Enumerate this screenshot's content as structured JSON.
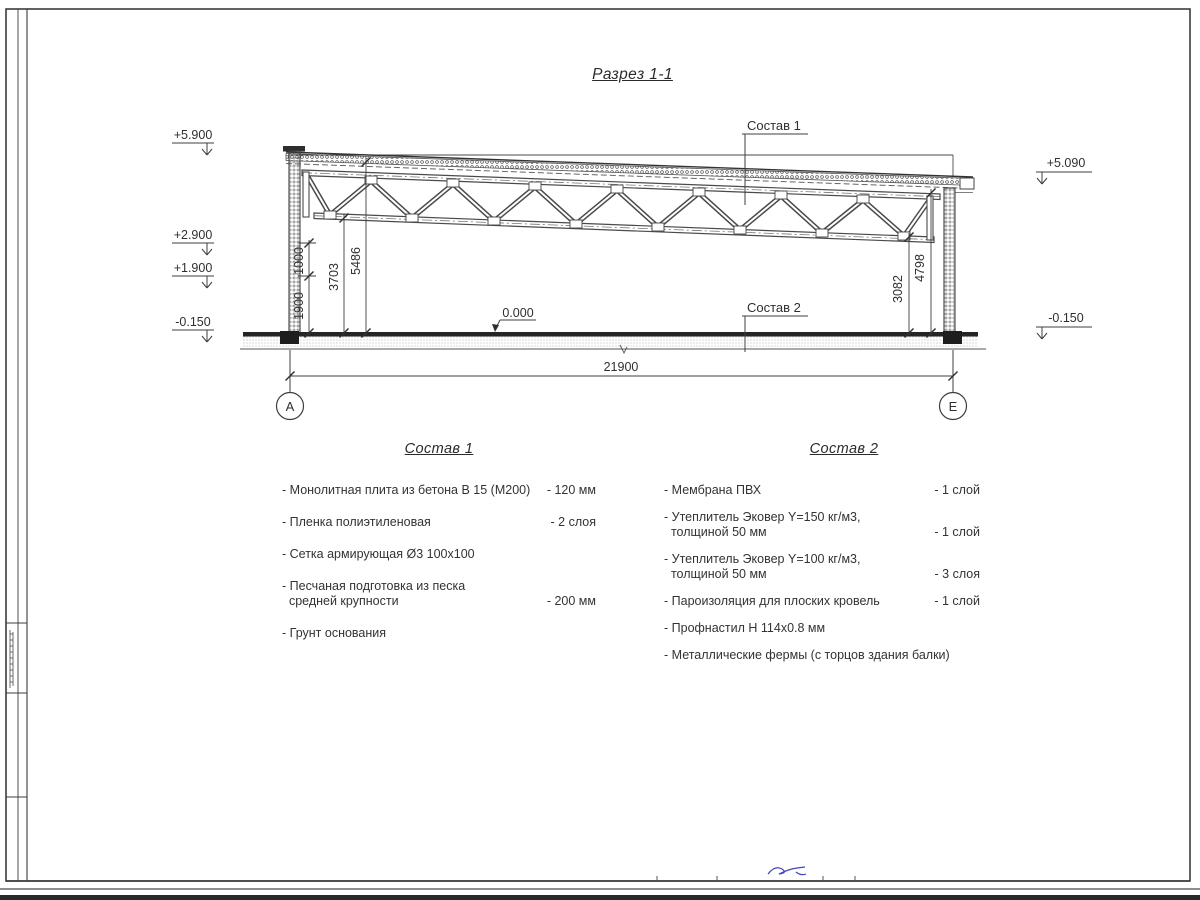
{
  "title": "Разрез 1-1",
  "drawing": {
    "left_elevations": [
      "+5.900",
      "+2.900",
      "+1.900",
      "-0.150"
    ],
    "right_elevations": [
      "+5.090",
      "-0.150"
    ],
    "floor_level": "0.000",
    "left_dims": [
      "1000",
      "1900",
      "3703",
      "5486"
    ],
    "right_dims": [
      "3082",
      "4798"
    ],
    "overall_dim": "21900",
    "composition1_label": "Состав 1",
    "composition2_label": "Состав 2",
    "grid_axes": [
      "А",
      "Е"
    ]
  },
  "composition1": {
    "heading": "Состав 1",
    "items": [
      {
        "name": "- Монолитная плита из бетона В 15 (М200)",
        "qty": "- 120 мм"
      },
      {
        "name": "- Пленка полиэтиленовая",
        "qty": "- 2 слоя"
      },
      {
        "name": "- Сетка армирующая Ø3 100х100",
        "qty": ""
      },
      {
        "name": "- Песчаная подготовка из песка\n  средней крупности",
        "qty": "- 200 мм"
      },
      {
        "name": "- Грунт основания",
        "qty": ""
      }
    ]
  },
  "composition2": {
    "heading": "Состав 2",
    "items": [
      {
        "name": "- Мембрана ПВХ",
        "qty": "- 1 слой"
      },
      {
        "name": "- Утеплитель Эковер Y=150 кг/м3,\n  толщиной 50 мм",
        "qty": "- 1 слой"
      },
      {
        "name": "- Утеплитель Эковер Y=100 кг/м3,\n  толщиной 50 мм",
        "qty": "- 3 слоя"
      },
      {
        "name": "- Пароизоляция для плоских кровель",
        "qty": "- 1 слой"
      },
      {
        "name": "- Профнастил Н 114х0.8 мм",
        "qty": ""
      },
      {
        "name": "- Металлические фермы (с торцов здания балки)",
        "qty": ""
      }
    ]
  }
}
